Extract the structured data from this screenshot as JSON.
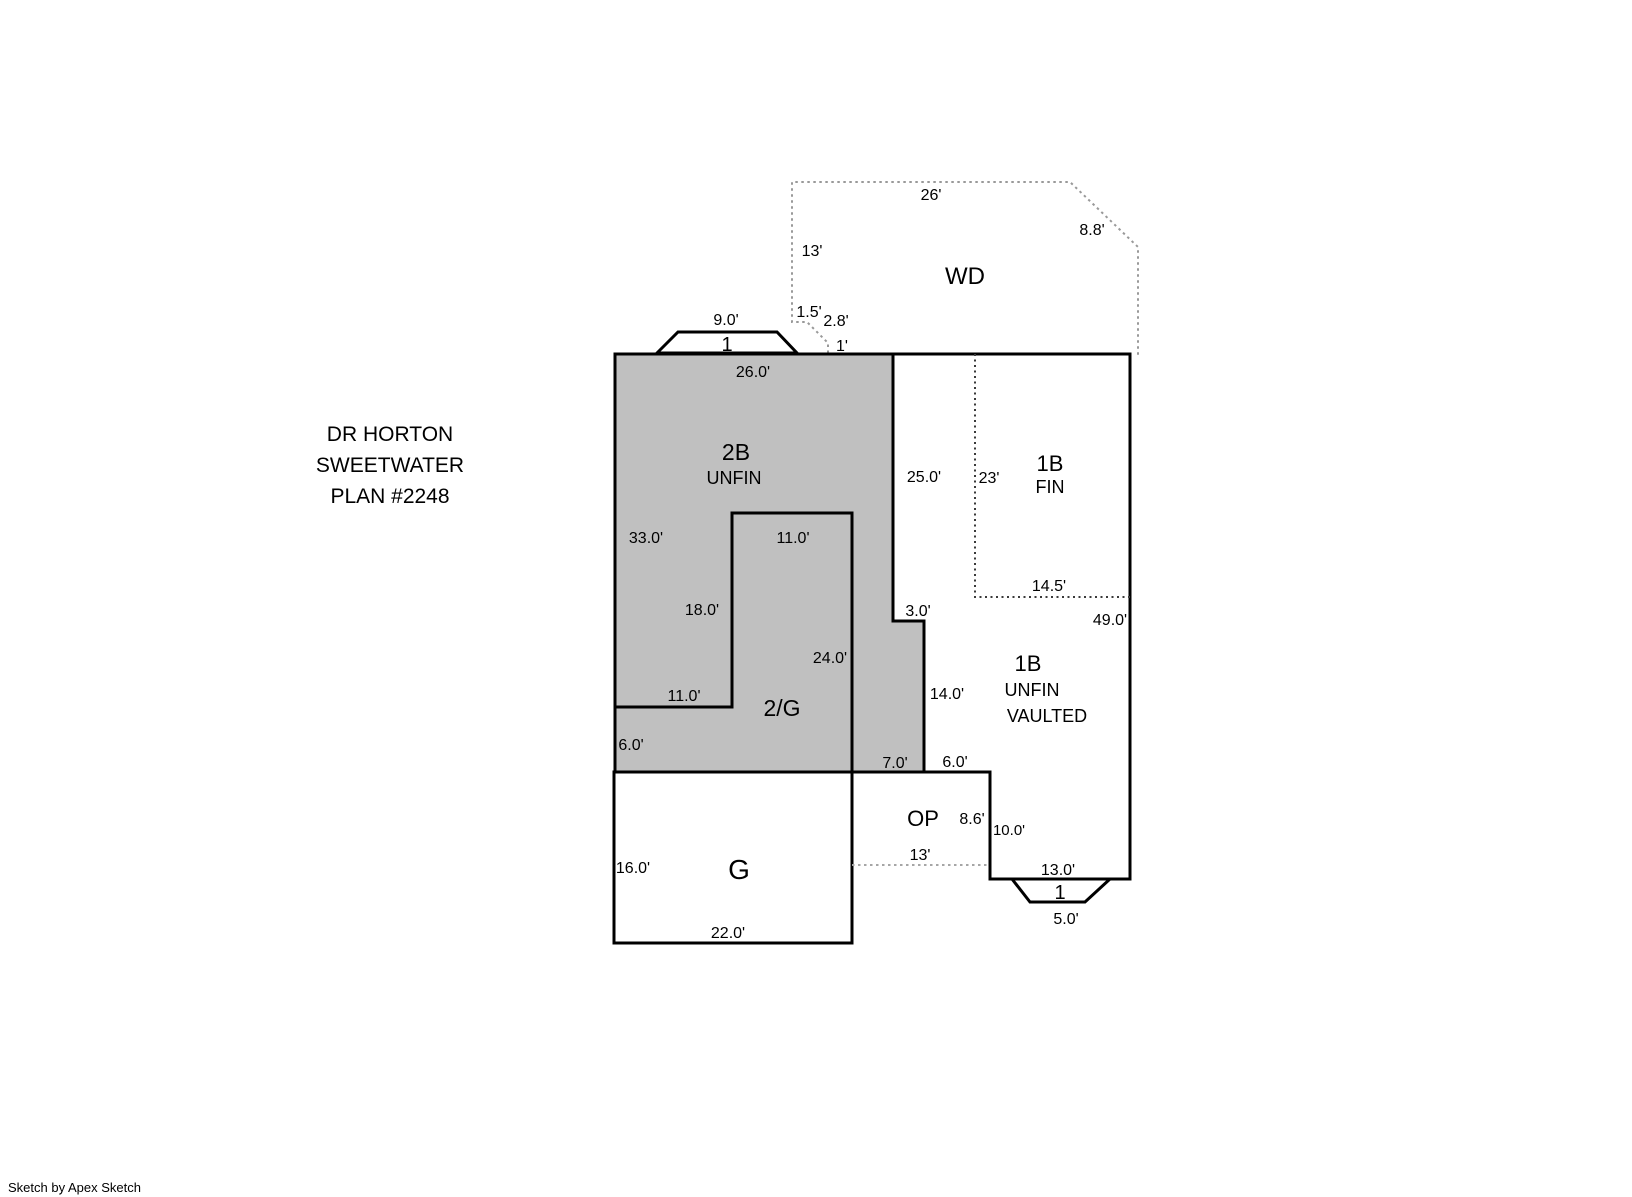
{
  "title": {
    "line1": "DR HORTON",
    "line2": "SWEETWATER",
    "line3": "PLAN #2248"
  },
  "footer": {
    "credit": "Sketch by Apex Sketch"
  },
  "colors": {
    "shaded_fill": "#c0c0c0",
    "outline": "#000000",
    "dotted_light": "#999999",
    "dotted_mid": "#a6a6a6",
    "dotted_dark": "#3a3a3a",
    "background": "#ffffff"
  },
  "plan": {
    "wd": {
      "label": "WD",
      "top": "26'",
      "left": "13'",
      "diagonal": "8.8'",
      "jog_horizontal": "1.5'",
      "jog_diagonal": "2.8'",
      "jog_vertical": "1'"
    },
    "bay_top": {
      "label": "1",
      "width": "9.0'"
    },
    "two_b": {
      "label": "2B",
      "finish": "UNFIN",
      "top": "26.0'",
      "left_upper": "33.0'",
      "left_lower": "6.0'",
      "right": "25.0'",
      "step": "3.0'",
      "step_side": "14.0'",
      "notch_top": "11.0'",
      "notch_left": "18.0'",
      "notch_right": "24.0'",
      "notch_bottom": "11.0'"
    },
    "two_g": {
      "label": "2/G"
    },
    "one_b_fin": {
      "label": "1B",
      "finish": "FIN",
      "side_dotted": "23'",
      "bottom_dotted": "14.5'"
    },
    "one_b_unfin": {
      "label": "1B",
      "finish": "UNFIN",
      "style": "VAULTED",
      "right": "49.0'",
      "bottom": "13.0'"
    },
    "op": {
      "label": "OP",
      "top_left": "7.0'",
      "top_right": "6.0'",
      "inner_right": "8.6'",
      "outer_right": "10.0'",
      "bottom": "13'"
    },
    "garage": {
      "label": "G",
      "left": "16.0'",
      "bottom": "22.0'"
    },
    "bay_bottom": {
      "label": "1",
      "width": "5.0'"
    }
  }
}
